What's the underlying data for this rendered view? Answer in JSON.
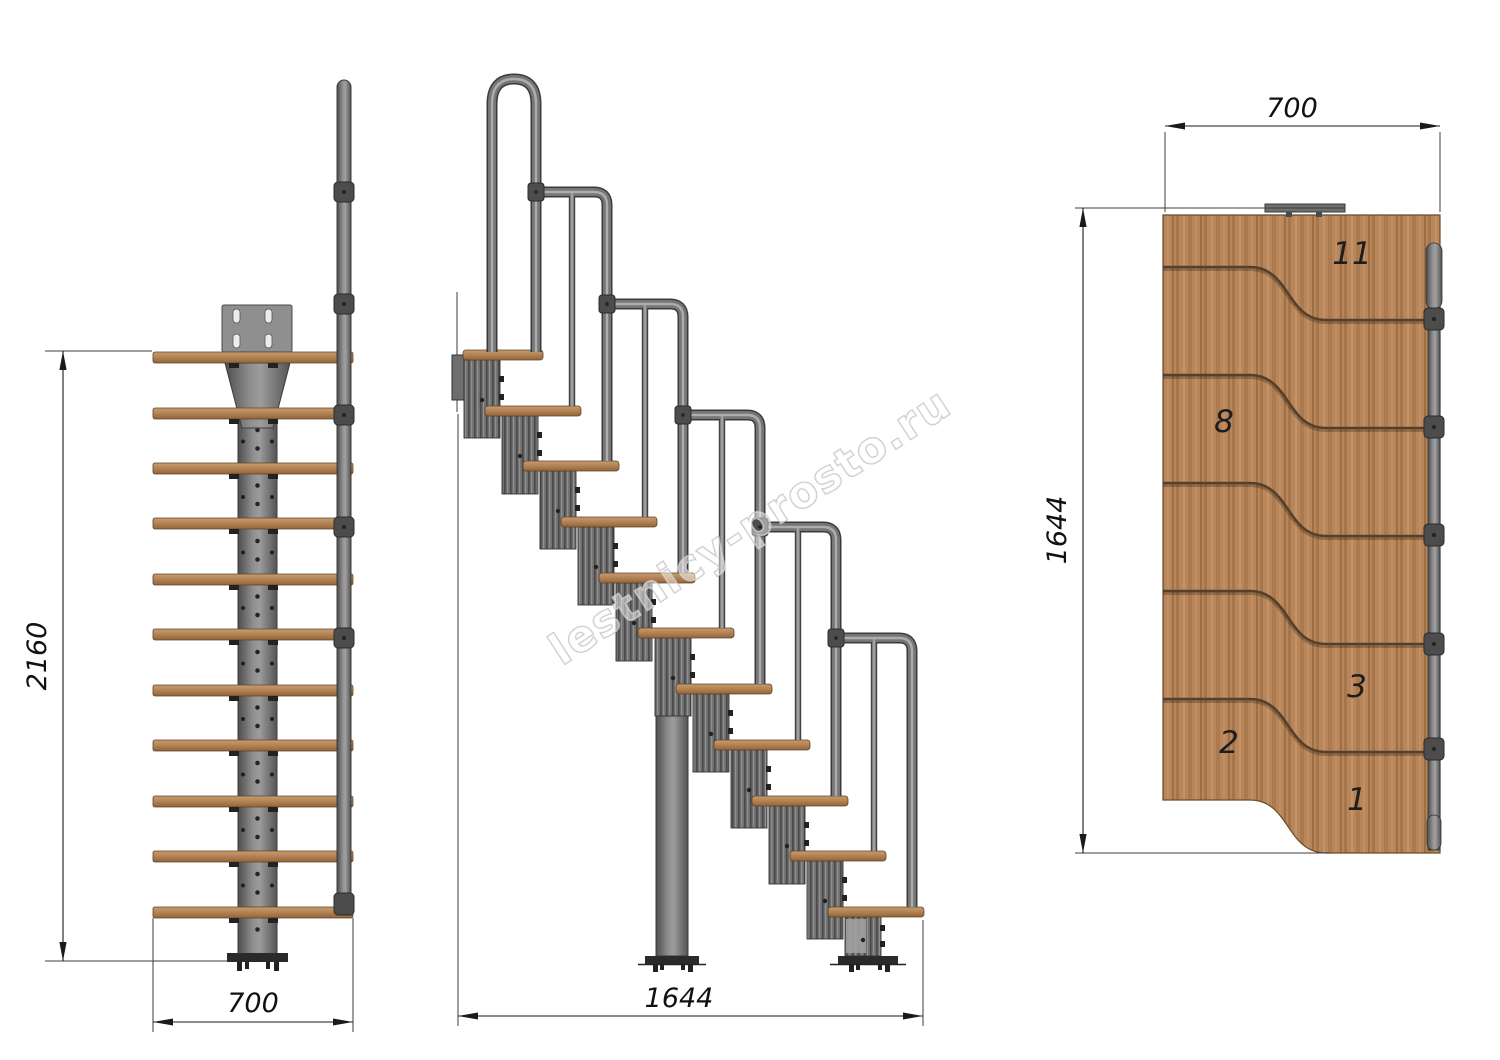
{
  "watermark": {
    "text": "lestnicy-prosto.ru",
    "color": "#bcbcbc"
  },
  "drawing": {
    "front_view": {
      "height_dim": "2160",
      "width_dim": "700"
    },
    "side_view": {
      "length_dim": "1644"
    },
    "plan_view": {
      "width_dim": "700",
      "length_dim": "1644",
      "step_labels": [
        "11",
        "8",
        "3",
        "2",
        "1"
      ]
    },
    "colors": {
      "wood": "#b8865a",
      "metal": "#7a7a7a",
      "dimension_lines": "#1a1a1a",
      "background": "#ffffff"
    }
  }
}
